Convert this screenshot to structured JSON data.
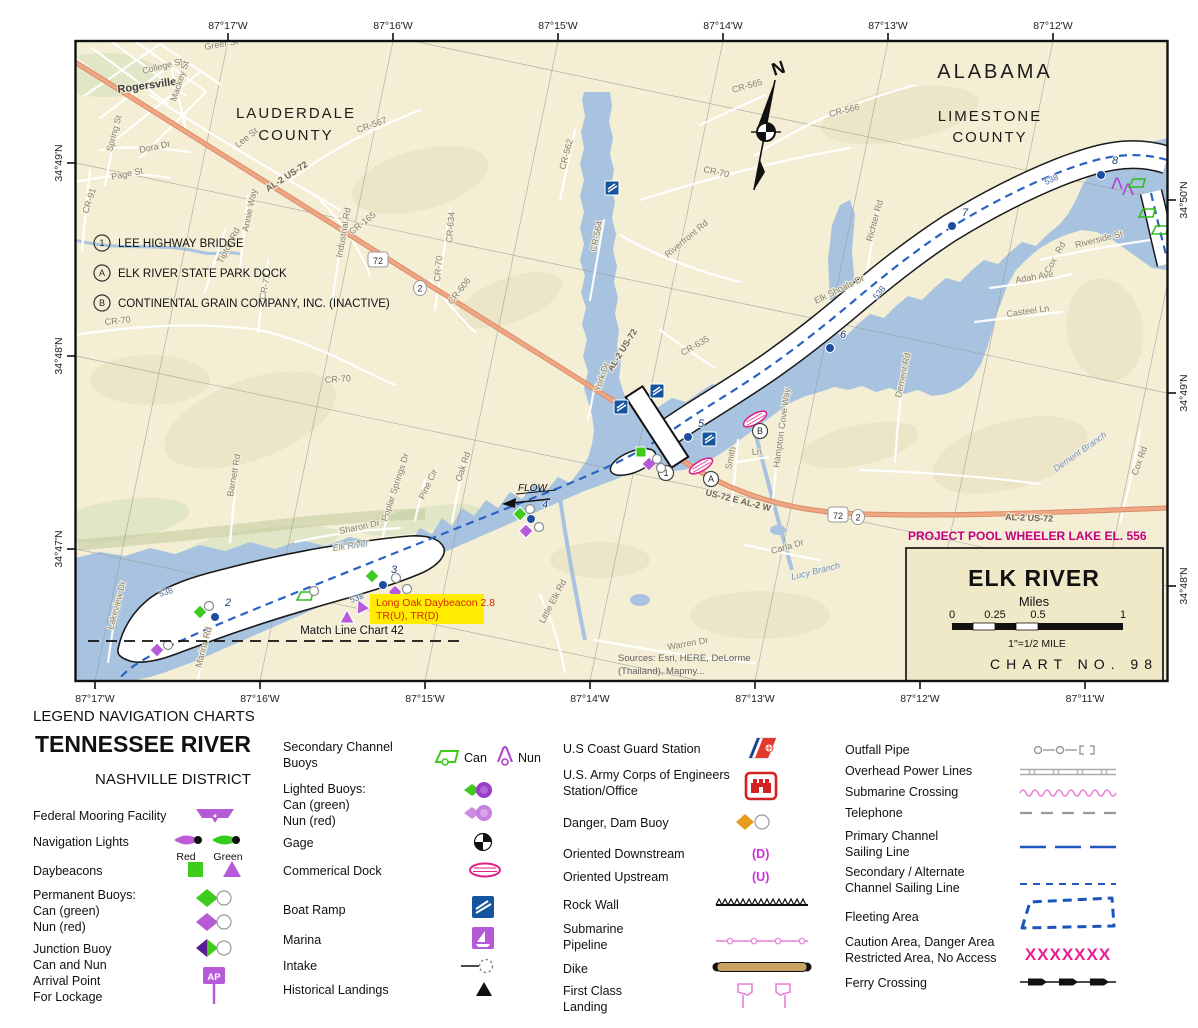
{
  "map": {
    "coords": {
      "top": [
        "87°17'W",
        "87°16'W",
        "87°15'W",
        "87°14'W",
        "87°13'W",
        "87°12'W"
      ],
      "bottom": [
        "87°17'W",
        "87°16'W",
        "87°15'W",
        "87°14'W",
        "87°13'W",
        "87°12'W",
        "87°11'W"
      ],
      "left": [
        "34°49'N",
        "34°48'N",
        "34°47'N"
      ],
      "right": [
        "34°50'N",
        "34°49'N",
        "34°48'N"
      ]
    },
    "state": "ALABAMA",
    "county1": [
      "LAUDERDALE",
      "COUNTY"
    ],
    "county2": [
      "LIMESTONE",
      "COUNTY"
    ],
    "key_notes": [
      {
        "marker": "1",
        "text": "LEE HIGHWAY BRIDGE"
      },
      {
        "marker": "A",
        "text": "ELK RIVER STATE PARK DOCK"
      },
      {
        "marker": "B",
        "text": "CONTINENTAL GRAIN COMPANY, INC. (INACTIVE)"
      }
    ],
    "bridge_markers": [
      "1",
      "A",
      "B"
    ],
    "north": "N",
    "flow": "FLOW",
    "project_pool": "PROJECT POOL WHEELER LAKE EL. 556",
    "callout": [
      "Long Oak Daybeacon 2.8",
      "TR(U), TR(D)"
    ],
    "match_line": "Match Line Chart 42",
    "sources": [
      "Sources: Esri, HERE, DeLorme",
      "(Thailand), Mapmy..."
    ],
    "shield_us": "72",
    "shield_state": "2",
    "channel_label": "538",
    "title_box": {
      "title": "ELK RIVER",
      "units": "Miles",
      "ticks": [
        "0",
        "0.25",
        "0.5",
        "1"
      ],
      "note": "1\"=1/2 MILE",
      "chart_no": "CHART NO. 98"
    },
    "mile_markers": [
      {
        "n": "2",
        "x": 215,
        "y": 617,
        "lx": 225,
        "ly": 606
      },
      {
        "n": "3",
        "x": 383,
        "y": 585,
        "lx": 391,
        "ly": 573
      },
      {
        "n": "4",
        "x": 531,
        "y": 519,
        "lx": 542,
        "ly": 508
      },
      {
        "n": "5",
        "x": 688,
        "y": 437,
        "lx": 698,
        "ly": 427
      },
      {
        "n": "6",
        "x": 830,
        "y": 348,
        "lx": 840,
        "ly": 338
      },
      {
        "n": "7",
        "x": 952,
        "y": 226,
        "lx": 962,
        "ly": 216
      },
      {
        "n": "8",
        "x": 1101,
        "y": 175,
        "lx": 1112,
        "ly": 164
      }
    ],
    "channel_labels": [
      {
        "x": 160,
        "y": 597,
        "r": -18
      },
      {
        "x": 351,
        "y": 603,
        "r": -20
      },
      {
        "x": 877,
        "y": 300,
        "r": -52
      },
      {
        "x": 1046,
        "y": 185,
        "r": -25
      }
    ],
    "road_labels": [
      {
        "t": "Rogersville",
        "x": 118,
        "y": 93,
        "r": -8,
        "c": "tl"
      },
      {
        "t": "College St",
        "x": 143,
        "y": 74,
        "r": -14
      },
      {
        "t": "Greer St",
        "x": 205,
        "y": 50,
        "r": -10
      },
      {
        "t": "Mackey St",
        "x": 176,
        "y": 102,
        "r": -72
      },
      {
        "t": "Spring St",
        "x": 112,
        "y": 152,
        "r": -75
      },
      {
        "t": "Dora Dr",
        "x": 140,
        "y": 153,
        "r": -12
      },
      {
        "t": "Page St",
        "x": 112,
        "y": 180,
        "r": -12
      },
      {
        "t": "CR-91",
        "x": 88,
        "y": 214,
        "r": -72
      },
      {
        "t": "Lee St",
        "x": 238,
        "y": 148,
        "r": -38
      },
      {
        "t": "CR-567",
        "x": 358,
        "y": 133,
        "r": -20
      },
      {
        "t": "CR-565",
        "x": 733,
        "y": 93,
        "r": -16
      },
      {
        "t": "CR-566",
        "x": 830,
        "y": 117,
        "r": -14
      },
      {
        "t": "CR-70",
        "x": 703,
        "y": 172,
        "r": 12
      },
      {
        "t": "CR-70",
        "x": 105,
        "y": 325,
        "r": -6
      },
      {
        "t": "CR-70",
        "x": 325,
        "y": 383,
        "r": -4
      },
      {
        "t": "AL-2 US-72",
        "x": 268,
        "y": 192,
        "r": -33,
        "c": "hl"
      },
      {
        "t": "AL-2 US-72",
        "x": 612,
        "y": 372,
        "r": -58,
        "c": "hl"
      },
      {
        "t": "US-72 E AL-2 W",
        "x": 705,
        "y": 495,
        "r": 14,
        "c": "hl"
      },
      {
        "t": "AL-2 US-72",
        "x": 1005,
        "y": 520,
        "r": 2,
        "c": "hl"
      },
      {
        "t": "CR-165",
        "x": 352,
        "y": 235,
        "r": -38
      },
      {
        "t": "Annie Way",
        "x": 248,
        "y": 232,
        "r": -78
      },
      {
        "t": "Industrial Rd",
        "x": 342,
        "y": 258,
        "r": -80
      },
      {
        "t": "Tipton Rd",
        "x": 222,
        "y": 264,
        "r": -62
      },
      {
        "t": "CR-77",
        "x": 265,
        "y": 300,
        "r": -78
      },
      {
        "t": "CR-606",
        "x": 452,
        "y": 305,
        "r": -52
      },
      {
        "t": "CR-70",
        "x": 440,
        "y": 282,
        "r": -85
      },
      {
        "t": "CR-634",
        "x": 452,
        "y": 243,
        "r": -85
      },
      {
        "t": "CR-562",
        "x": 565,
        "y": 170,
        "r": -75
      },
      {
        "t": "CR-564",
        "x": 596,
        "y": 252,
        "r": -78
      },
      {
        "t": "Riverfront Rd",
        "x": 668,
        "y": 258,
        "r": -40
      },
      {
        "t": "CR-635",
        "x": 683,
        "y": 356,
        "r": -30
      },
      {
        "t": "York Dr",
        "x": 600,
        "y": 392,
        "r": -72
      },
      {
        "t": "Richter Rd",
        "x": 872,
        "y": 242,
        "r": -75
      },
      {
        "t": "Elk Shoals Dr",
        "x": 816,
        "y": 304,
        "r": -26
      },
      {
        "t": "Smith",
        "x": 731,
        "y": 470,
        "r": -78
      },
      {
        "t": "Ln",
        "x": 752,
        "y": 455,
        "r": -5
      },
      {
        "t": "Hampton Cove Way",
        "x": 779,
        "y": 468,
        "r": -82
      },
      {
        "t": "Carla Dr",
        "x": 772,
        "y": 554,
        "r": -16
      },
      {
        "t": "Dement Rd",
        "x": 901,
        "y": 398,
        "r": -78
      },
      {
        "t": "Dement Branch",
        "x": 1056,
        "y": 472,
        "r": -35,
        "c": "wl"
      },
      {
        "t": "Cox Rd",
        "x": 1137,
        "y": 476,
        "r": -70
      },
      {
        "t": "Adah Ave",
        "x": 1016,
        "y": 283,
        "r": -10
      },
      {
        "t": "Cox",
        "x": 1049,
        "y": 274,
        "r": -60
      },
      {
        "t": "Rd",
        "x": 1060,
        "y": 254,
        "r": -60
      },
      {
        "t": "Casteel Ln",
        "x": 1007,
        "y": 317,
        "r": -8
      },
      {
        "t": "Riverside St",
        "x": 1076,
        "y": 248,
        "r": -14
      },
      {
        "t": "Barnett Rd",
        "x": 233,
        "y": 497,
        "r": -80
      },
      {
        "t": "Oak Rd",
        "x": 461,
        "y": 482,
        "r": -72
      },
      {
        "t": "Pine Cir",
        "x": 424,
        "y": 500,
        "r": -65
      },
      {
        "t": "Poplar Springs Dr",
        "x": 387,
        "y": 522,
        "r": -72
      },
      {
        "t": "Sharon Dr",
        "x": 340,
        "y": 534,
        "r": -12
      },
      {
        "t": "Elk River",
        "x": 333,
        "y": 551,
        "r": -8,
        "c": "wl"
      },
      {
        "t": "Lakeview Dr",
        "x": 113,
        "y": 630,
        "r": -75
      },
      {
        "t": "Marina Rd",
        "x": 201,
        "y": 668,
        "r": -75
      },
      {
        "t": "Little Elk Rd",
        "x": 544,
        "y": 624,
        "r": -62
      },
      {
        "t": "Lucy Branch",
        "x": 792,
        "y": 580,
        "r": -14,
        "c": "wl"
      },
      {
        "t": "Warren Dr",
        "x": 668,
        "y": 650,
        "r": -10
      }
    ],
    "buoys": [
      {
        "t": "wc",
        "x": 209,
        "y": 606
      },
      {
        "t": "gd",
        "x": 200,
        "y": 612
      },
      {
        "t": "pd",
        "x": 157,
        "y": 650
      },
      {
        "t": "wc",
        "x": 168,
        "y": 645
      },
      {
        "t": "gd",
        "x": 372,
        "y": 576
      },
      {
        "t": "wc",
        "x": 396,
        "y": 578
      },
      {
        "t": "pd",
        "x": 395,
        "y": 592
      },
      {
        "t": "wc",
        "x": 407,
        "y": 589
      },
      {
        "t": "can",
        "x": 305,
        "y": 596
      },
      {
        "t": "wc",
        "x": 314,
        "y": 591
      },
      {
        "t": "pt",
        "x": 347,
        "y": 617
      },
      {
        "t": "pt",
        "x": 361,
        "y": 606,
        "r": -25
      },
      {
        "t": "wc",
        "x": 530,
        "y": 509
      },
      {
        "t": "gd",
        "x": 520,
        "y": 514
      },
      {
        "t": "pd",
        "x": 526,
        "y": 531
      },
      {
        "t": "wc",
        "x": 539,
        "y": 527
      },
      {
        "t": "gs",
        "x": 641,
        "y": 452
      },
      {
        "t": "pd",
        "x": 649,
        "y": 464
      },
      {
        "t": "wc",
        "x": 657,
        "y": 459
      },
      {
        "t": "wc",
        "x": 661,
        "y": 468
      },
      {
        "t": "nun",
        "x": 1117,
        "y": 184
      },
      {
        "t": "nun",
        "x": 1128,
        "y": 190
      },
      {
        "t": "can",
        "x": 1137,
        "y": 183
      },
      {
        "t": "can",
        "x": 1147,
        "y": 213
      },
      {
        "t": "can",
        "x": 1160,
        "y": 230
      }
    ]
  },
  "legend": {
    "header": "LEGEND NAVIGATION CHARTS",
    "title": "TENNESSEE RIVER",
    "subtitle": "NASHVILLE DISTRICT",
    "col1": {
      "federal_mooring": "Federal Mooring Facility",
      "navigation_lights": "Navigation Lights",
      "red": "Red",
      "green": "Green",
      "daybeacons": "Daybeacons",
      "permanent_buoys": "Permanent Buoys:",
      "can_green": "Can (green)",
      "nun_red": "Nun (red)",
      "junction_1": "Junction Buoy",
      "junction_2": "Can and Nun",
      "arrival_1": "Arrival Point",
      "arrival_2": "For Lockage",
      "ap": "AP"
    },
    "col2": {
      "secondary_1": "Secondary Channel",
      "secondary_2": "Buoys",
      "can": "Can",
      "nun": "Nun",
      "lighted_1": "Lighted Buoys:",
      "lighted_2": "Can (green)",
      "lighted_3": "Nun (red)",
      "gage": "Gage",
      "commercial_dock": "Commerical Dock",
      "boat_ramp": "Boat Ramp",
      "marina": "Marina",
      "intake": "Intake",
      "historical_landings": "Historical Landings"
    },
    "col3": {
      "uscg": "U.S Coast Guard Station",
      "usace_1": "U.S. Army Corps of Engineers",
      "usace_2": "Station/Office",
      "danger": "Danger, Dam Buoy",
      "oriented_down": "Oriented Downstream",
      "d": "(D)",
      "oriented_up": "Oriented Upstream",
      "u": "(U)",
      "rock_wall": "Rock Wall",
      "submarine_1": "Submarine",
      "submarine_2": "Pipeline",
      "dike": "Dike",
      "first_class_1": "First Class",
      "first_class_2": "Landing"
    },
    "col4": {
      "outfall": "Outfall Pipe",
      "overhead": "Overhead Power Lines",
      "submarine_crossing": "Submarine Crossing",
      "telephone": "Telephone",
      "primary_1": "Primary Channel",
      "primary_2": "Sailing Line",
      "secondary_alt_1": "Secondary / Alternate",
      "secondary_alt_2": "Channel Sailing Line",
      "fleeting": "Fleeting Area",
      "caution_1": "Caution Area, Danger Area",
      "caution_2": "Restricted Area, No Access",
      "caution_pattern": "XXXXXXX",
      "ferry": "Ferry Crossing"
    }
  }
}
